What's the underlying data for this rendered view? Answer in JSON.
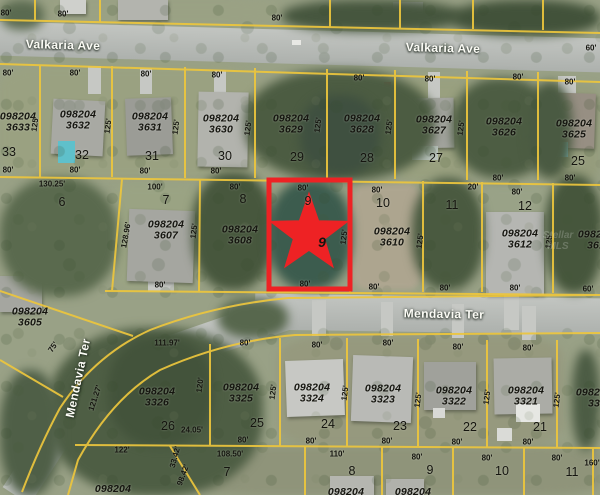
{
  "streets": {
    "valkaria": "Valkaria Ave",
    "mendavia": "Mendavia Ter"
  },
  "watermark": "Stellar MLS",
  "colors": {
    "boundary": "#edc63d",
    "highlight": "#ee2224",
    "road": "#b5b9b3"
  },
  "dims": {
    "d20": "20'",
    "d60": "60'",
    "d75": "75'",
    "d80": "80'",
    "d100": "100'",
    "d110": "110'",
    "d120": "120'",
    "d122": "122'",
    "d125": "125'",
    "d160": "160'",
    "d24_05": "24.05'",
    "d33_42": "33.42'",
    "d98_42": "98.42'",
    "d108_50": "108.50'",
    "d111_97": "111.97'",
    "d121_27": "121.27'",
    "d128_96": "128.96'",
    "d130_25": "130.25'"
  },
  "parcels": {
    "p3633": {
      "id": "098204\n3633",
      "lot": "33"
    },
    "p3632": {
      "id": "098204\n3632",
      "lot": "32"
    },
    "p3631": {
      "id": "098204\n3631",
      "lot": "31"
    },
    "p3630": {
      "id": "098204\n3630",
      "lot": "30"
    },
    "p3629": {
      "id": "098204\n3629",
      "lot": "29"
    },
    "p3628": {
      "id": "098204\n3628",
      "lot": "28"
    },
    "p3627": {
      "id": "098204\n3627",
      "lot": "27"
    },
    "p3626": {
      "id": "098204\n3626"
    },
    "p3625": {
      "id": "098204\n3625",
      "lot": "25"
    },
    "p3607": {
      "id": "098204\n3607",
      "lot": "7"
    },
    "p3608": {
      "id": "098204\n3608",
      "lot": "8"
    },
    "p3609": {
      "lot": "9",
      "partial_digit": "9"
    },
    "p3610": {
      "id": "098204\n3610",
      "lot": "10"
    },
    "p3612": {
      "id": "098204\n3612",
      "lot": "12"
    },
    "p361x": {
      "id": "098204\n361"
    },
    "p3605": {
      "id": "098204\n3605"
    },
    "p3326": {
      "id": "098204\n3326",
      "lot": "26"
    },
    "p3325": {
      "id": "098204\n3325",
      "lot": "25"
    },
    "p3324": {
      "id": "098204\n3324",
      "lot": "24"
    },
    "p3323": {
      "id": "098204\n3323",
      "lot": "23"
    },
    "p3322": {
      "id": "098204\n3322",
      "lot": "22"
    },
    "p3321": {
      "id": "098204\n3321",
      "lot": "21"
    },
    "p33xx": {
      "id": "098204\n33"
    },
    "p3327": {
      "id": "098204"
    },
    "lot6": {
      "lot": "6"
    },
    "lot11": {
      "lot": "11"
    },
    "sub7": {
      "lot": "7"
    },
    "sub8": {
      "lot": "8",
      "partial_id": "098204"
    },
    "sub9": {
      "lot": "9",
      "partial_id": "098204"
    },
    "sub10": {
      "lot": "10"
    },
    "sub11": {
      "lot": "11"
    }
  }
}
